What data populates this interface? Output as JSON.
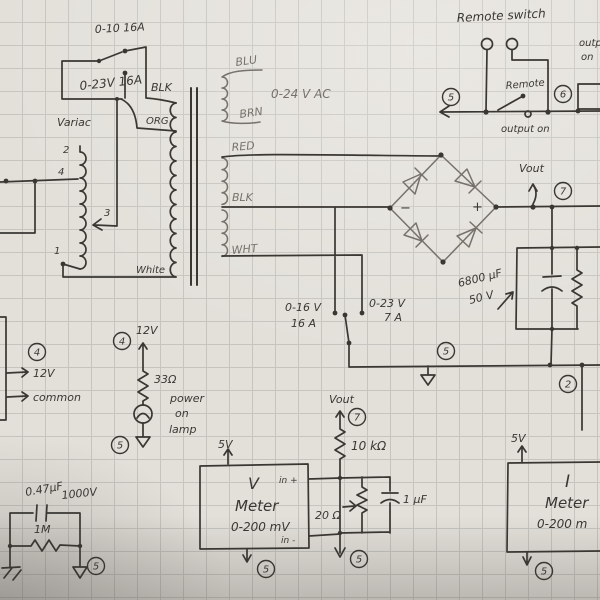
{
  "schematic": {
    "input": {
      "breaker_top": "0-10  16A",
      "breaker_mid": "0-23V 16A",
      "blk": "BLK",
      "org": "ORG",
      "variac": "Variac",
      "tap2": "2",
      "tap4": "4",
      "tap3": "3",
      "tap1": "1",
      "white": "White"
    },
    "xfmr": {
      "blu": "BLU",
      "brn": "BRN",
      "aux_winding": "0-24 V AC",
      "red": "RED",
      "blk": "BLK",
      "wht": "WHT"
    },
    "selector": {
      "left_v": "0-16 V",
      "left_a": "16 A",
      "right_v": "0-23 V",
      "right_a": "7 A"
    },
    "remote": {
      "title": "Remote switch",
      "remote": "Remote",
      "output_on": "output on",
      "corner1": "output",
      "corner2": "on"
    },
    "bridge": {
      "minus": "−",
      "plus": "+",
      "vout": "Vout"
    },
    "filter": {
      "cap": "6800 µF",
      "cap_v": "50 V"
    },
    "aux": {
      "v12": "12V",
      "common": "common"
    },
    "lamp": {
      "v12": "12V",
      "res": "33Ω",
      "l1": "power",
      "l2": "on",
      "l3": "lamp"
    },
    "snubber": {
      "cap": "0.47µF",
      "voltage": "1000V",
      "res": "1M"
    },
    "vmeter": {
      "supply": "5V",
      "name1": "V",
      "name2": "Meter",
      "range": "0-200 mV",
      "in_pos": "in +",
      "in_neg": "in -"
    },
    "divider": {
      "vout": "Vout",
      "r": "10 kΩ",
      "pot": "20 Ω",
      "cap": "1 µF"
    },
    "imeter": {
      "supply": "5V",
      "name1": "I",
      "name2": "Meter",
      "range": "0-200 m"
    },
    "circled": {
      "two": "2",
      "four": "4",
      "five": "5",
      "six": "6",
      "seven": "7"
    }
  }
}
